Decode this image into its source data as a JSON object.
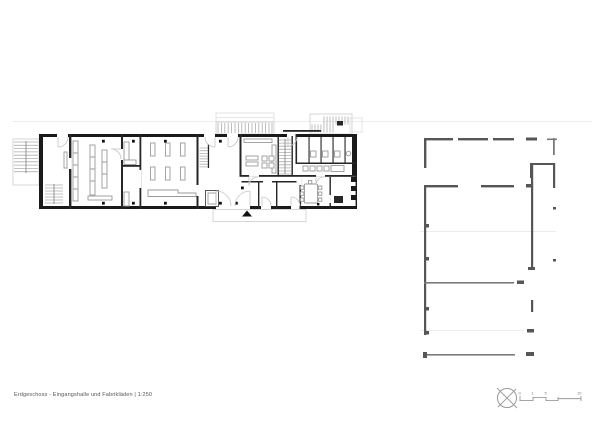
{
  "drawing": {
    "type": "architectural-floor-plan",
    "caption": "Erdgeschoss - Eingangshalle und Fabrikläden | 1:250",
    "title": "Erdgeschoss",
    "subtitle": "Eingangshalle und Fabrikläden",
    "scale": "1:250"
  },
  "scale_bar": {
    "labels": [
      "0",
      "1",
      "5",
      "10"
    ]
  },
  "icons": {
    "north_symbol": "compass-circle-cross-icon",
    "entrance_marker": "solid-triangle-up"
  },
  "colors": {
    "building_walls": "#1a1a1a",
    "adjacent_structure": "#565656",
    "furniture_outline": "#9a9a9a",
    "stair_hatch": "#8c8c8c",
    "site_lines": "#ececec",
    "caption_text": "#555555",
    "background": "#ffffff"
  }
}
